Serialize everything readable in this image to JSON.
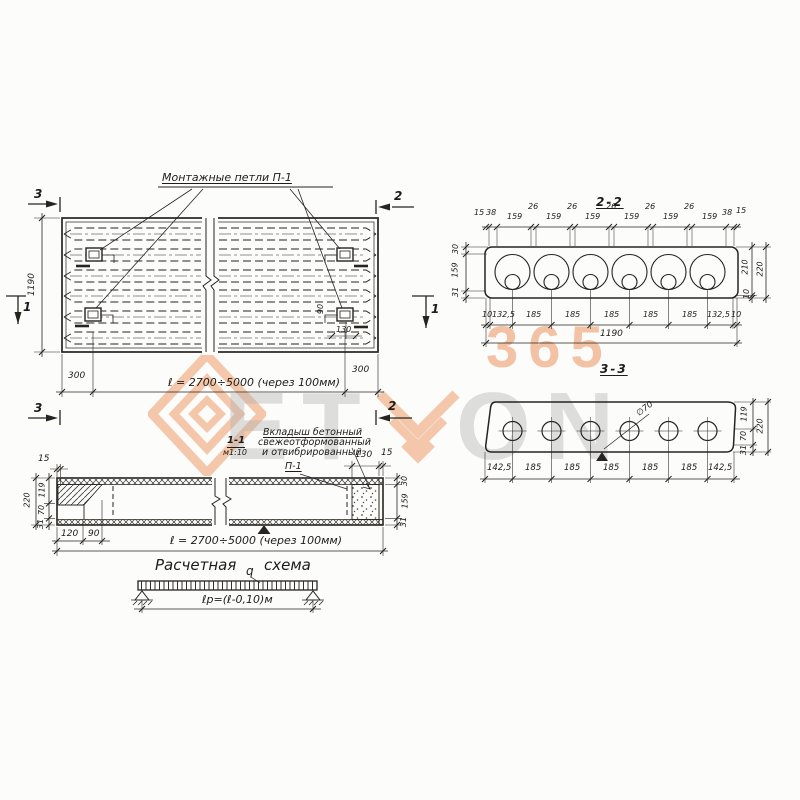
{
  "watermark": {
    "brand_left": "ET",
    "brand_right": "ON",
    "number": "365"
  },
  "plan": {
    "loops_label": "Монтажные петли П-1",
    "height": "1190",
    "left_300": "300",
    "right_300": "300",
    "length": "ℓ = 2700÷5000 (через 100мм)",
    "marker3": "3",
    "marker2": "2",
    "marker1": "1",
    "loop_90": "90",
    "loop_130": "130"
  },
  "s22": {
    "title": "2-2",
    "top": [
      "15",
      "38",
      "159",
      "26",
      "159",
      "26",
      "159",
      "26",
      "159",
      "26",
      "159",
      "26",
      "159",
      "38",
      "15"
    ],
    "left": [
      "30",
      "159",
      "31"
    ],
    "right210": "210",
    "right220": "220",
    "right10": "10",
    "bottom": [
      "10",
      "132,5",
      "185",
      "185",
      "185",
      "185",
      "185",
      "132,5",
      "10"
    ],
    "total": "1190"
  },
  "s33": {
    "title": "3-3",
    "dia": "∅70",
    "bottom": [
      "142,5",
      "185",
      "185",
      "185",
      "185",
      "185",
      "142,5"
    ],
    "right": [
      "119",
      "70",
      "31"
    ],
    "total": "220"
  },
  "s11": {
    "title": "1-1",
    "scale": "м1:10",
    "note1": "Вкладыш бетонный",
    "note2": "свежеотформованный",
    "note3": "и отвибрированный",
    "loop": "П-1",
    "top_left15": "15",
    "top130": "130",
    "top15": "15",
    "left220": "220",
    "left": [
      "119",
      "70",
      "31"
    ],
    "right": [
      "30",
      "159",
      "31"
    ],
    "b120": "120",
    "b90": "90",
    "length": "ℓ = 2700÷5000 (через 100мм)"
  },
  "scheme": {
    "title1": "Расчетная",
    "title2": "схема",
    "q": "q",
    "span": "ℓр=(ℓ-0,10)м"
  }
}
